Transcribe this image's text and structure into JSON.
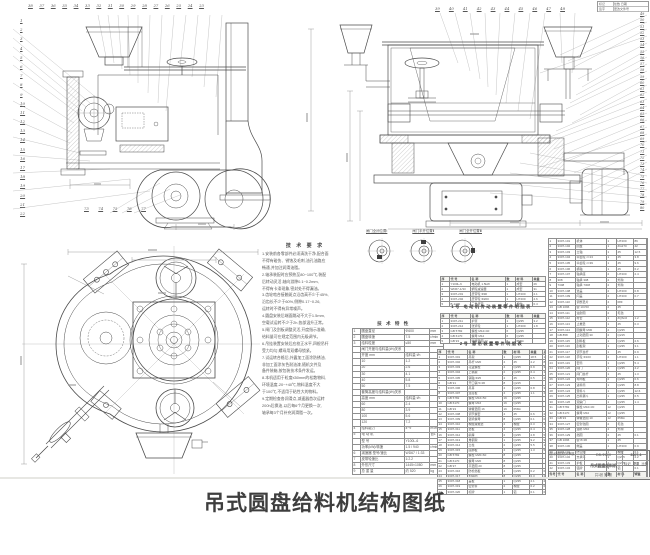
{
  "caption": "吊式圆盘给料机结构图纸",
  "stamp": {
    "r1l": "标记",
    "r1r": "处数  日期",
    "r2l": "签字",
    "r2r": "更改文件号"
  },
  "callouts": {
    "left_col": [
      "1",
      "2",
      "3",
      "4",
      "5",
      "6",
      "7",
      "8",
      "9",
      "10",
      "11",
      "12",
      "13",
      "14",
      "15",
      "16",
      "17",
      "18",
      "19",
      "20",
      "21",
      "22"
    ],
    "top_left_row": [
      "38",
      "37",
      "36",
      "35",
      "34",
      "33",
      "32",
      "31",
      "30",
      "29",
      "28",
      "27",
      "26",
      "25",
      "24",
      "23"
    ],
    "bottom_left_row": [
      "73",
      "74",
      "75",
      "76",
      "77"
    ],
    "top_right_row": [
      "39",
      "40",
      "41",
      "42",
      "43",
      "44",
      "45",
      "46",
      "47",
      "48"
    ],
    "right_col": [
      "49",
      "50",
      "51",
      "52",
      "53",
      "54",
      "55",
      "56",
      "57",
      "58",
      "59",
      "60",
      "61",
      "62",
      "63",
      "64",
      "65",
      "66",
      "67",
      "68",
      "69",
      "70",
      "71",
      "72",
      "73",
      "74",
      "75",
      "76",
      "77",
      "78",
      "79",
      "80"
    ]
  },
  "detail_labels": [
    "闸门全闭位置Ⅰ",
    "闸门半开位置Ⅱ",
    "闸门全开位置Ⅲ"
  ],
  "notes": {
    "title": "技 术 要 求",
    "lines": [
      "1.安装前各零部件必须清洗干净,配合面",
      "  不得有碰伤、锈蚀及毛刺,油孔油路应",
      "  畅通,并加注润滑油脂。",
      "2.轴承装配时应预热至80~100℃,装配",
      "  后转动灵活,轴向游隙0.1~0.2mm,",
      "  不得有卡滞现象,密封处不得漏油。",
      "3.齿轮啮合接触斑点沿齿高不少于45%,",
      "  沿齿长不少于60%,侧隙0.17~0.26,",
      "  运转时不得有异常噪声。",
      "4.圆盘安装后端面跳动不大于1.5mm,",
      "  空载试运转不少于2h,各部温升正常。",
      "5.闸门及刮板调整灵活,开度指示准确,",
      "  给料量可在规定范围内无级调节。",
      "6.吊挂装置安装后应校正水平,四根吊杆",
      "  受力均匀,螺母用双螺母锁紧。",
      "7.试运转合格后,外露加工面涂防锈油,",
      "  非加工面涂灰色耐油漆,随机文件及",
      "  备件装箱,按包装技术条件发运。",
      "8.本机适用于粒度≤50mm的松散物料,",
      "  环境温度-20~+40℃,物料温度不大",
      "  于100℃,不适用于粘性大的物料。",
      "9.定期检查各润滑点,减速器首次运转",
      "  200h后换油,以后每6个月更换一次,",
      "  轴承每3个月补充润滑脂一次。"
    ]
  },
  "spec_table": {
    "title": "技  术  特  性",
    "rows": [
      [
        "1",
        "圆盘直径",
        "Φ600",
        "mm"
      ],
      [
        "2",
        "圆盘转速",
        "7.5",
        "r/min"
      ],
      [
        "3",
        "给料粒度",
        "≤50",
        "mm"
      ],
      [
        "",
        "闸门开度与给料量(t/h)关系",
        "",
        ""
      ],
      [
        "",
        "开度 mm",
        "给料量 t/h",
        ""
      ],
      [
        "",
        "10",
        "1.2",
        ""
      ],
      [
        "",
        "20",
        "2.6",
        ""
      ],
      [
        "",
        "30",
        "4.1",
        ""
      ],
      [
        "",
        "40",
        "5.8",
        ""
      ],
      [
        "",
        "50",
        "7.5",
        ""
      ],
      [
        "",
        "套筒高度与给料量(t/h)关系",
        "",
        ""
      ],
      [
        "",
        "高度 mm",
        "给料量 t/h",
        ""
      ],
      [
        "",
        "60",
        "2.4",
        ""
      ],
      [
        "",
        "80",
        "3.9",
        ""
      ],
      [
        "",
        "100",
        "5.6",
        ""
      ],
      [
        "",
        "120",
        "7.2",
        ""
      ],
      [
        "4",
        "给料能力",
        "4~9",
        "m³/h"
      ],
      [
        "5",
        "电 动 机",
        "",
        "台1"
      ],
      [
        "",
        "型  号",
        "Y100L-6",
        ""
      ],
      [
        "",
        "功率(kW)/转速",
        "1.5 / 940",
        "r/min"
      ],
      [
        "6",
        "减速器 型号/速比",
        "WD67 / 1:33",
        ""
      ],
      [
        "7",
        "皮带轮速比",
        "1:2.2",
        ""
      ],
      [
        "8",
        "外形尺寸",
        "1445×1080",
        "mm"
      ],
      [
        "9",
        "总 重 量",
        "约 520",
        "kg"
      ]
    ]
  },
  "bom_mid": {
    "heading_a": "1号 电动机传动装置零件明细表",
    "table_a": [
      [
        "序",
        "代  号",
        "名     称",
        "数",
        "材 料",
        "单重",
        "备注"
      ],
      [
        "1",
        "Y100L-6",
        "电动机 1.5kW",
        "1",
        "成套",
        "26",
        "外购"
      ],
      [
        "2",
        "WD67-1/33",
        "蜗轮减速器",
        "1",
        "成套",
        "31",
        "外购"
      ],
      [
        "3",
        "3307-201",
        "皮带轮 Φ90",
        "1",
        "HT200",
        "2.1",
        ""
      ],
      [
        "4",
        "3307-202",
        "皮带轮 Φ200",
        "1",
        "HT200",
        "4.6",
        ""
      ],
      [
        "5",
        "B-1400",
        "三角皮带",
        "2",
        "橡胶",
        "0.4",
        "外购"
      ]
    ],
    "heading_b": "2号 悬吊装置零件明细表",
    "table_b": [
      [
        "序",
        "代  号",
        "名     称",
        "数",
        "材 料",
        "单重",
        "备注"
      ],
      [
        "1",
        "3307-211",
        "护罩",
        "1",
        "Q235",
        "3.2",
        ""
      ],
      [
        "2",
        "3307-212",
        "张紧轮",
        "1",
        "HT200",
        "1.8",
        ""
      ],
      [
        "3",
        "GB 5782",
        "螺栓 M12×40",
        "6",
        "Q235",
        "",
        ""
      ],
      [
        "4",
        "GB 6170",
        "螺母 M12",
        "6",
        "Q235",
        "",
        ""
      ],
      [
        "5",
        "GB 93",
        "弹簧垫圈 12",
        "6",
        "65Mn",
        "",
        ""
      ]
    ],
    "table_c": [
      [
        "序",
        "代   号",
        "名     称",
        "数",
        "材 料",
        "单重",
        "总重"
      ],
      [
        "1",
        "3307-301",
        "吊架",
        "1",
        "Q235",
        "18.5",
        "18.5"
      ],
      [
        "2",
        "3307-302",
        "吊杆 M20",
        "4",
        "45",
        "2.2",
        "8.8"
      ],
      [
        "3",
        "3307-303",
        "花篮螺栓",
        "4",
        "Q235",
        "0.9",
        "3.6"
      ],
      [
        "4",
        "3307-304",
        "上横梁",
        "2",
        "Q235",
        "6.4",
        "12.8"
      ],
      [
        "5",
        "3307-305",
        "销轴 Φ25",
        "4",
        "45",
        "0.5",
        "2.0"
      ],
      [
        "6",
        "GB 91",
        "开口销 5×36",
        "8",
        "Q215",
        "",
        ""
      ],
      [
        "7",
        "3307-306",
        "吊耳",
        "4",
        "Q235",
        "0.8",
        "3.2"
      ],
      [
        "8",
        "3307-307",
        "连接板",
        "4",
        "Q235",
        "1.1",
        "4.4"
      ],
      [
        "9",
        "GB 5782",
        "螺栓 M16×50",
        "16",
        "Q235",
        "",
        ""
      ],
      [
        "10",
        "GB 6170",
        "螺母 M16",
        "16",
        "Q235",
        "",
        ""
      ],
      [
        "11",
        "GB 93",
        "弹簧垫圈 16",
        "16",
        "65Mn",
        "",
        ""
      ],
      [
        "12",
        "3307-308",
        "调节螺套",
        "4",
        "45",
        "0.6",
        "2.4"
      ],
      [
        "13",
        "3307-309",
        "锁紧螺母",
        "8",
        "Q235",
        "0.1",
        "0.8"
      ],
      [
        "14",
        "3307-310",
        "橡胶减振垫",
        "4",
        "橡胶",
        "0.3",
        "1.2"
      ],
      [
        "15",
        "3307-311",
        "垫板",
        "4",
        "Q235",
        "0.4",
        "1.6"
      ],
      [
        "16",
        "3307-312",
        "斜撑",
        "2",
        "Q235",
        "2.8",
        "5.6"
      ],
      [
        "17",
        "3307-313",
        "角钢架",
        "1",
        "Q235",
        "9.2",
        "9.2"
      ],
      [
        "18",
        "3307-314",
        "立柱",
        "2",
        "Q235",
        "5.5",
        "11.0"
      ],
      [
        "19",
        "3307-315",
        "底脚板",
        "4",
        "Q235",
        "1.3",
        "5.2"
      ],
      [
        "20",
        "GB 5782",
        "螺栓 M20×60",
        "8",
        "Q235",
        "",
        ""
      ],
      [
        "21",
        "GB 6170",
        "螺母 M20",
        "8",
        "Q235",
        "",
        ""
      ],
      [
        "22",
        "GB 97",
        "平垫圈 20",
        "8",
        "Q235",
        "",
        ""
      ],
      [
        "23",
        "3307-316",
        "防松挡板",
        "4",
        "Q235",
        "0.2",
        "0.8"
      ],
      [
        "24",
        "3307-317",
        "加强肋",
        "8",
        "Q235",
        "0.3",
        "2.4"
      ],
      [
        "25",
        "3307-318",
        "盖板",
        "1",
        "Q235",
        "2.1",
        "2.1"
      ],
      [
        "26",
        "3307-319",
        "密封条",
        "2",
        "橡胶",
        "0.2",
        "0.4"
      ],
      [
        "27",
        "3307-320",
        "标牌",
        "1",
        "铝",
        "0.1",
        "0.1"
      ]
    ]
  },
  "bom_right": {
    "rows": [
      [
        "1",
        "3307-101",
        "机体",
        "1",
        "HT200",
        "86",
        "86"
      ],
      [
        "2",
        "3307-102",
        "圆盘",
        "1",
        "ZG270",
        "42",
        "42"
      ],
      [
        "3",
        "3307-103",
        "立轴",
        "1",
        "45",
        "12.5",
        "12.5"
      ],
      [
        "4",
        "3307-104",
        "伞齿轮 z=13",
        "1",
        "45",
        "3.8",
        "3.8"
      ],
      [
        "5",
        "3307-105",
        "伞齿轮 z=39",
        "1",
        "45",
        "9.6",
        "9.6"
      ],
      [
        "6",
        "3307-106",
        "横轴",
        "1",
        "45",
        "6.2",
        "6.2"
      ],
      [
        "7",
        "3307-107",
        "轴承座",
        "2",
        "HT200",
        "2.4",
        "4.8"
      ],
      [
        "8",
        "308",
        "轴承 308",
        "2",
        "外购",
        "",
        ""
      ],
      [
        "9",
        "7308",
        "轴承 7308",
        "2",
        "外购",
        "",
        ""
      ],
      [
        "10",
        "3307-108",
        "透盖",
        "2",
        "HT200",
        "0.8",
        "1.6"
      ],
      [
        "11",
        "3307-109",
        "闷盖",
        "2",
        "HT200",
        "0.7",
        "1.4"
      ],
      [
        "12",
        "3307-110",
        "调整垫片",
        "4",
        "08F",
        "",
        ""
      ],
      [
        "13",
        "GB 1096",
        "键 10×50",
        "2",
        "45",
        "",
        ""
      ],
      [
        "14",
        "3307-111",
        "油封圈",
        "2",
        "毛毡",
        "",
        ""
      ],
      [
        "15",
        "3307-112",
        "衬套",
        "1",
        "ZQSn6",
        "1.2",
        "1.2"
      ],
      [
        "16",
        "3307-113",
        "止推垫",
        "1",
        "45",
        "0.3",
        "0.3"
      ],
      [
        "17",
        "3307-114",
        "圆螺母 M30",
        "2",
        "Q235",
        "",
        ""
      ],
      [
        "18",
        "GB 858",
        "止动垫圈 30",
        "2",
        "Q215",
        "",
        ""
      ],
      [
        "19",
        "3307-115",
        "刮料板",
        "1",
        "Q235",
        "2.6",
        "2.6"
      ],
      [
        "20",
        "3307-116",
        "刮板架",
        "1",
        "Q235",
        "3.1",
        "3.1"
      ],
      [
        "21",
        "3307-117",
        "调节丝杆",
        "1",
        "45",
        "0.9",
        "0.9"
      ],
      [
        "22",
        "3307-118",
        "手轮 Φ160",
        "2",
        "HT200",
        "1.1",
        "2.2"
      ],
      [
        "23",
        "3307-119",
        "套筒",
        "1",
        "Q235",
        "5.4",
        "5.4"
      ],
      [
        "24",
        "3307-120",
        "闸门",
        "1",
        "Q235",
        "4.2",
        "4.2"
      ],
      [
        "25",
        "3307-121",
        "闸门丝杆",
        "1",
        "45",
        "1.3",
        "1.3"
      ],
      [
        "26",
        "3307-122",
        "导向板",
        "2",
        "Q235",
        "0.6",
        "1.2"
      ],
      [
        "27",
        "3307-123",
        "进料筒",
        "1",
        "Q235",
        "8.8",
        "8.8"
      ],
      [
        "28",
        "3307-124",
        "受料斗",
        "1",
        "Q235",
        "12.6",
        "12.6"
      ],
      [
        "29",
        "3307-125",
        "出料漏斗",
        "1",
        "Q235",
        "6.5",
        "6.5"
      ],
      [
        "30",
        "3307-126",
        "观察门",
        "1",
        "Q235",
        "1.4",
        "1.4"
      ],
      [
        "31",
        "GB 5782",
        "螺栓 M10×30",
        "12",
        "Q235",
        "",
        ""
      ],
      [
        "32",
        "GB 6170",
        "螺母 M10",
        "12",
        "Q235",
        "",
        ""
      ],
      [
        "33",
        "GB 93",
        "弹簧垫圈 10",
        "12",
        "65Mn",
        "",
        ""
      ],
      [
        "34",
        "3307-127",
        "密封毡圈",
        "2",
        "毛毡",
        "",
        ""
      ],
      [
        "35",
        "3307-128",
        "油杯 M10",
        "4",
        "外购",
        "",
        ""
      ],
      [
        "36",
        "3307-129",
        "挡圈",
        "2",
        "45",
        "0.1",
        "0.2"
      ],
      [
        "37",
        "GB 1096",
        "键 8×36",
        "1",
        "45",
        "",
        ""
      ],
      [
        "38",
        "3307-130",
        "端盖",
        "1",
        "HT200",
        "0.9",
        "0.9"
      ],
      [
        "39",
        "3307-131",
        "防尘圈",
        "1",
        "橡胶",
        "0.1",
        "0.1"
      ],
      [
        "40",
        "3307-132",
        "支承环",
        "1",
        "Q235",
        "2.2",
        "2.2"
      ],
      [
        "41",
        "3307-133",
        "护板",
        "1",
        "Q235",
        "1.8",
        "1.8"
      ],
      [
        "42",
        "3307-134",
        "铭牌",
        "1",
        "铝",
        "0.1",
        "0.1"
      ],
      [
        "件号",
        "代  号",
        "名   称",
        "数",
        "材 料",
        "单重",
        "总重"
      ]
    ]
  },
  "title_block": {
    "roles": [
      "设计",
      "制图",
      "校对",
      "审核"
    ],
    "model": "DB-Φ600",
    "product": "吊式圆盘给料机",
    "drawing_no": "3307-1",
    "marks": [
      "标记",
      "重量",
      "比例"
    ],
    "scale": "1:5",
    "sheet": "共1张 第1张"
  }
}
